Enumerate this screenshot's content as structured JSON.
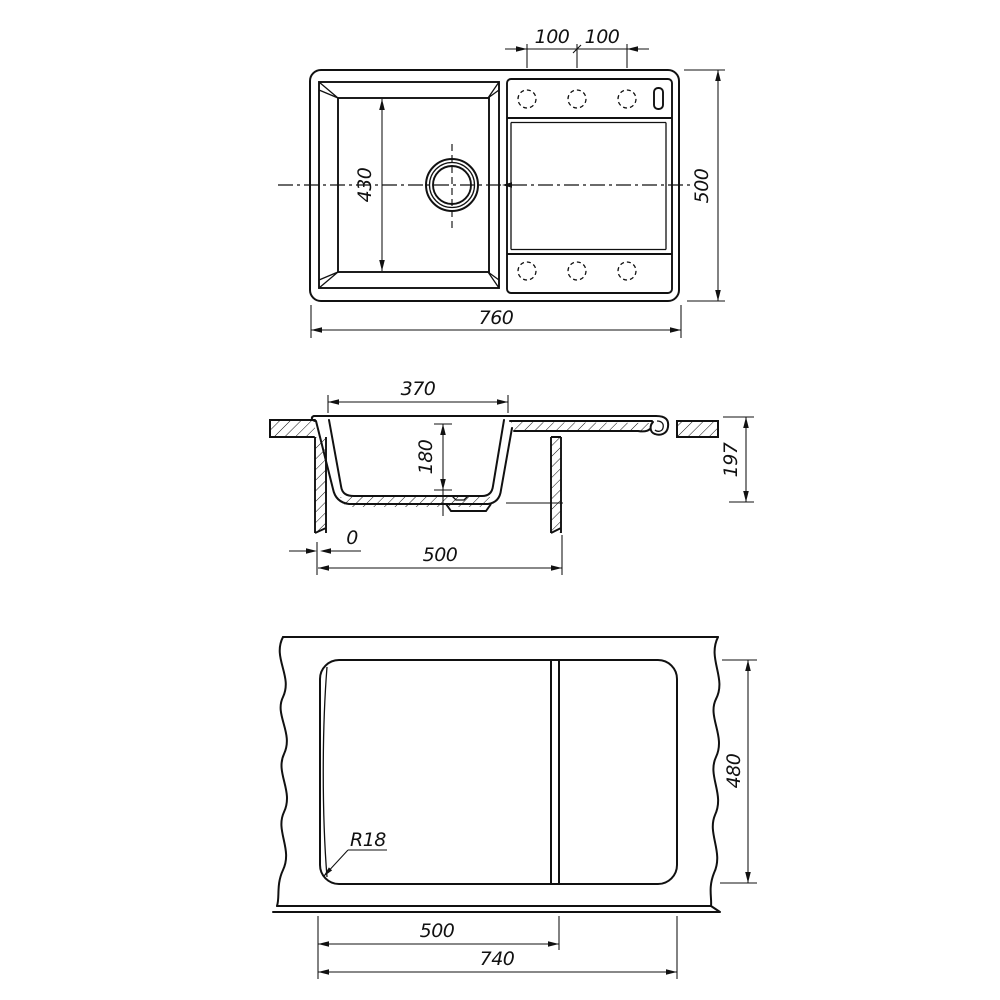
{
  "title": "Kitchen sink technical drawing",
  "colors": {
    "line": "#111111",
    "background": "#ffffff"
  },
  "top_view": {
    "hole_pitch_left_mm": "100",
    "hole_pitch_right_mm": "100",
    "bowl_inner_length_mm": "430",
    "overall_length_mm": "760",
    "overall_depth_mm": "500"
  },
  "section_view": {
    "bowl_top_width_mm": "370",
    "bowl_depth_mm": "180",
    "overall_height_mm": "197",
    "edge_offset_mm": "0",
    "cabinet_width_mm": "500"
  },
  "cutout_view": {
    "corner_radius": "R18",
    "cutout_depth_mm": "480",
    "divider_offset_mm": "500",
    "cutout_width_mm": "740"
  }
}
